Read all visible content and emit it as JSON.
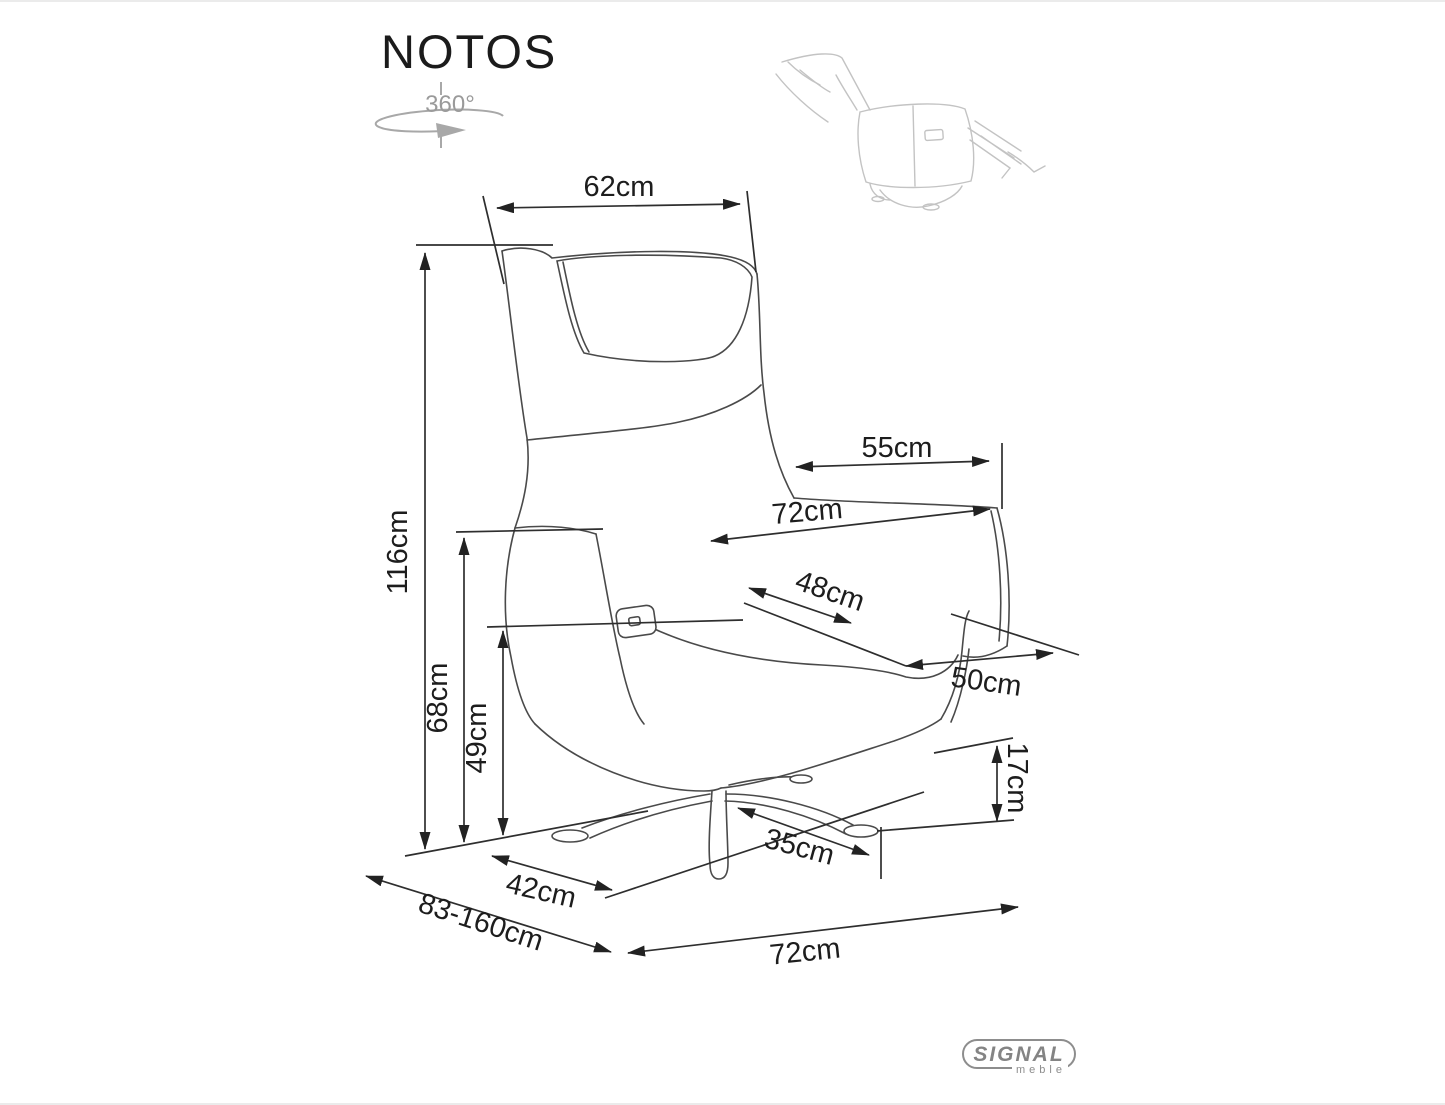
{
  "product": {
    "name": "NOTOS"
  },
  "rotation_badge": {
    "label": "360°"
  },
  "dimensions": {
    "top_width": "62cm",
    "total_height": "116cm",
    "armrest_length": "55cm",
    "width_at_armrests": "72cm",
    "seat_width": "48cm",
    "armrest_height": "68cm",
    "seat_height": "49cm",
    "seat_depth": "50cm",
    "under_seat_clearance": "17cm",
    "base_leg_length": "35cm",
    "base_front_span": "42cm",
    "depth_extended_range": "83-160cm",
    "overall_width": "72cm"
  },
  "brand": {
    "name": "SIGNAL",
    "sub": "meble"
  },
  "colors": {
    "line": "#2e2e2e",
    "chair_line": "#4a4a4a",
    "sketch_line": "#c3c3c3",
    "brand_gray": "#848484",
    "background": "#ffffff"
  }
}
